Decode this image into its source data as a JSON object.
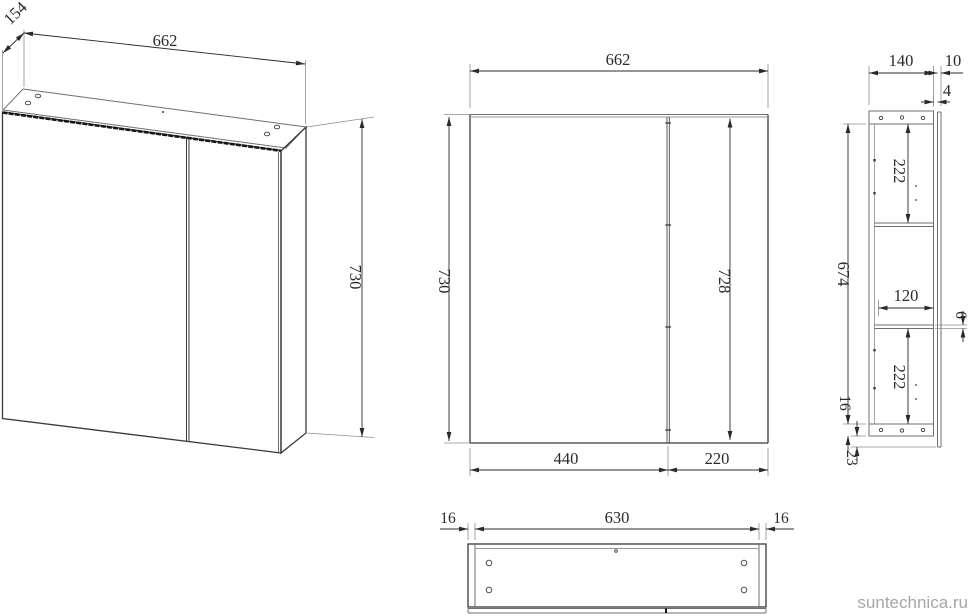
{
  "watermark": "suntechnica.ru",
  "views": {
    "iso": {
      "name": "isometric view",
      "labels": {
        "depth": "154",
        "width": "662",
        "height": "730"
      }
    },
    "front": {
      "name": "front view",
      "labels": {
        "width": "662",
        "height": "730",
        "door_height": "728",
        "left_door_width": "440",
        "right_door_width": "220"
      }
    },
    "side": {
      "name": "side section view",
      "labels": {
        "depth": "140",
        "door_thickness": "10",
        "front_gap": "4",
        "top_shelf_space": "222",
        "inner_height": "674",
        "shelf_depth": "120",
        "shelf_thickness": "6",
        "bottom_shelf_space": "222",
        "bottom_panel_thickness": "16",
        "door_overhang": "23"
      }
    },
    "bottom": {
      "name": "bottom view",
      "labels": {
        "left_wall": "16",
        "inner_width": "630",
        "right_wall": "16"
      }
    }
  },
  "colors": {
    "outline": "#3a3a3a",
    "secondary": "#8d8d8d",
    "dimension": "#2a2a2a",
    "watermark": "#a6a6a6",
    "background": "#ffffff"
  }
}
